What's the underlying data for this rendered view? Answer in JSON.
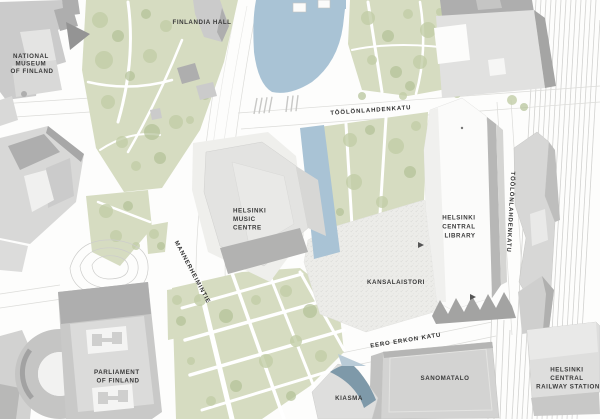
{
  "labels": {
    "national_museum": {
      "lines": [
        "NATIONAL",
        "MUSEUM",
        "OF FINLAND"
      ]
    },
    "finlandia_hall": {
      "text": "FINLANDIA HALL"
    },
    "toolonlahdenkatu_north": {
      "text": "TÖÖLÖNLAHDENKATU"
    },
    "helsinki_music_centre": {
      "lines": [
        "HELSINKI",
        "MUSIC",
        "CENTRE"
      ]
    },
    "mannerheimintie": {
      "text": "MANNERHEIMINTIE"
    },
    "kansalaistori": {
      "text": "KANSALAISTORI"
    },
    "helsinki_central_library": {
      "lines": [
        "HELSINKI",
        "CENTRAL",
        "LIBRARY"
      ]
    },
    "parliament": {
      "lines": [
        "PARLIAMENT",
        "OF FINLAND"
      ]
    },
    "eero_erkon_katu": {
      "text": "EERO ERKON KATU"
    },
    "sanomatalo": {
      "text": "SANOMATALO"
    },
    "kiasma": {
      "text": "KIASMA"
    },
    "helsinki_central_railway_station": {
      "lines": [
        "HELSINKI",
        "CENTRAL",
        "RAILWAY STATION"
      ]
    },
    "toolonlahdenkatu_east": {
      "text": "TÖÖLÖNLAHDENKATU"
    }
  },
  "icons": {
    "entrance_arrow_marker": "triangle-right"
  },
  "colors": {
    "background": "#fdfdfc",
    "water": "#a9c3d5",
    "park": "#d6dcc1",
    "tree": "#c2cda6",
    "tree_dark": "#b2c096",
    "building_light": "#e3e3e2",
    "building_mid": "#cbcbcb",
    "building_dark": "#aeaeae",
    "building_shadow": "#949494",
    "library_white": "#fbfbfa",
    "plaza": "#ecece9",
    "street_line": "#dcdcd9",
    "rail_line": "#d2d2d0",
    "kiasma_blue": "#7e99a9",
    "kiasma_blue_light": "#b9cbd7",
    "label_text": "#3a3a3a"
  }
}
